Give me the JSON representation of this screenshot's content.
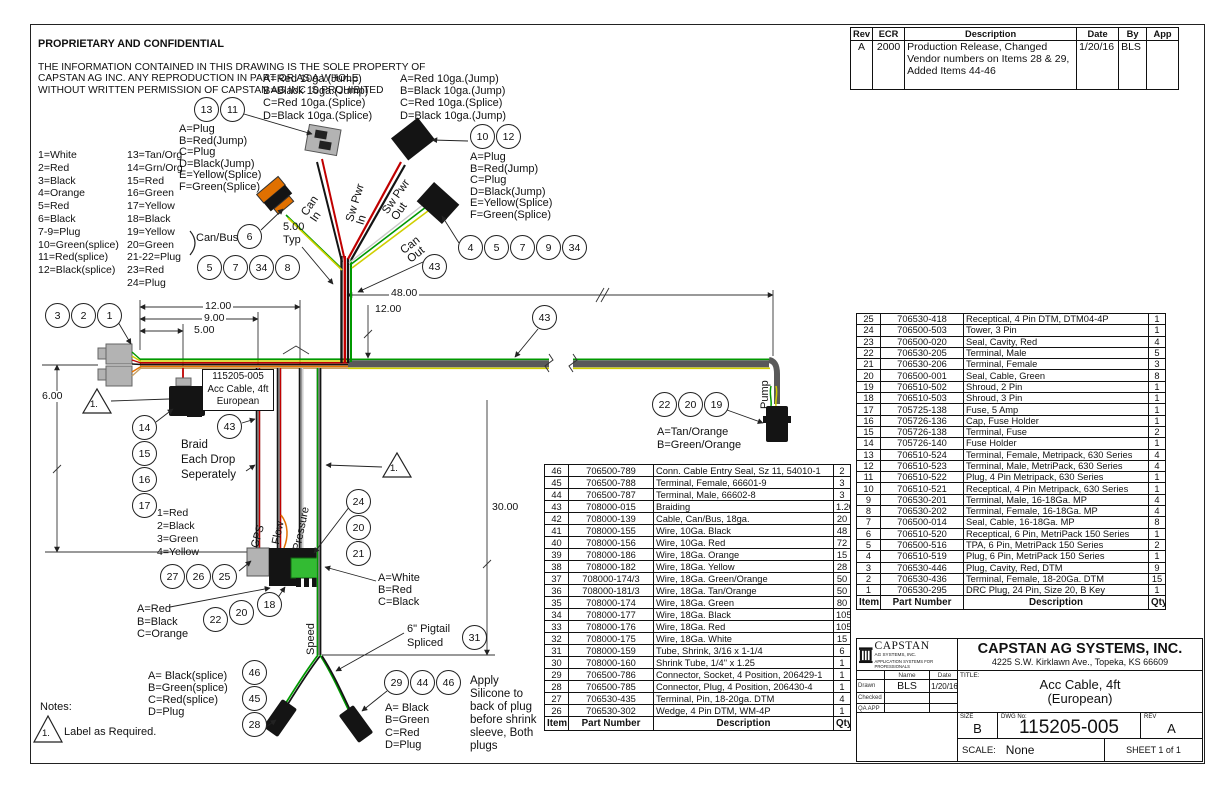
{
  "proprietary": {
    "title": "PROPRIETARY AND CONFIDENTIAL",
    "body": [
      "THE INFORMATION CONTAINED IN THIS DRAWING IS THE SOLE PROPERTY OF",
      "CAPSTAN AG INC. ANY REPRODUCTION IN PART OR AS A WHOLE",
      "WITHOUT WRITTEN PERMISSION OF CAPSTAN AG INC IS PROHIBITED"
    ]
  },
  "rev_table": {
    "headers": [
      "Rev",
      "ECR",
      "Description",
      "Date",
      "By",
      "App"
    ],
    "rows": [
      [
        "A",
        "2000",
        "Production Release, Changed Vendor numbers on Items 28 & 29, Added Items 44-46",
        "1/20/16",
        "BLS",
        ""
      ]
    ]
  },
  "legend": {
    "col1": [
      "1=White",
      "2=Red",
      "3=Black",
      "4=Orange",
      "5=Red",
      "6=Black",
      "7-9=Plug",
      "10=Green(splice)",
      "11=Red(splice)",
      "12=Black(splice)"
    ],
    "col2": [
      "13=Tan/Org",
      "14=Grn/Org",
      "15=Red",
      "16=Green",
      "17=Yellow",
      "18=Black",
      "19=Yellow",
      "20=Green",
      "21-22=Plug",
      "23=Red",
      "24=Plug"
    ],
    "canbus": "Can/Bus"
  },
  "callouts": {
    "jump_left": [
      "A=Red 10ga.(Jump)",
      "B=Black 10ga.(Jump)",
      "C=Red 10ga.(Splice)",
      "D=Black 10ga.(Splice)"
    ],
    "jump_right": [
      "A=Red 10ga.(Jump)",
      "B=Black 10ga.(Jump)",
      "C=Red 10ga.(Splice)",
      "D=Black 10ga.(Jump)"
    ],
    "plug_left": [
      "A=Plug",
      "B=Red(Jump)",
      "C=Plug",
      "D=Black(Jump)",
      "E=Yellow(Splice)",
      "F=Green(Splice)"
    ],
    "plug_right": [
      "A=Plug",
      "B=Red(Jump)",
      "C=Plug",
      "D=Black(Jump)",
      "E=Yellow(Splice)",
      "F=Green(Splice)"
    ],
    "five_typ": [
      "5.00",
      "Typ"
    ],
    "part_box": [
      "115205-005",
      "Acc Cable, 4ft",
      "European"
    ],
    "braid_note": [
      "Braid",
      "Each Drop",
      "Seperately"
    ],
    "pump_pins": [
      "A=Tan/Orange",
      "B=Green/Orange"
    ],
    "gps_pins": [
      "1=Red",
      "2=Black",
      "3=Green",
      "4=Yellow"
    ],
    "flow_pins": [
      "A=Red",
      "B=Black",
      "C=Orange"
    ],
    "pressure_pins": [
      "A=White",
      "B=Red",
      "C=Black"
    ],
    "speed_left_pins": [
      "A= Black(splice)",
      "B=Green(splice)",
      "C=Red(splice)",
      "D=Plug"
    ],
    "speed_right_pins": [
      "A= Black",
      "B=Green",
      "C=Red",
      "D=Plug"
    ],
    "pigtail_note": [
      "6\" Pigtail",
      "Spliced"
    ],
    "silicone_note": [
      "Apply",
      "Silicone to",
      "back of plug",
      "before shrink",
      "sleeve, Both",
      "plugs"
    ]
  },
  "wire_labels": {
    "sw_pwr_in": [
      "Sw Pwr",
      "In"
    ],
    "sw_pwr_out": [
      "Sw Pwr",
      "Out"
    ],
    "can_in": [
      "Can",
      "In"
    ],
    "can_out": [
      "Can",
      "Out"
    ],
    "pump": "Pump",
    "gps": "GPS",
    "flow": "Flow",
    "pressure": "Pressure",
    "speed": "Speed"
  },
  "dims": {
    "d48": "48.00",
    "d12_top": "12.00",
    "d12": "12.00",
    "d9": "9.00",
    "d5": "5.00",
    "d6": "6.00",
    "d30": "30.00"
  },
  "flags": {
    "f1": "1.",
    "f2": "1."
  },
  "notes": {
    "title": "Notes:",
    "flag": "1.",
    "note1": "Label as Required."
  },
  "balloons": {
    "g13_11": [
      13,
      11
    ],
    "g10_12": [
      10,
      12
    ],
    "g6": [
      6
    ],
    "row5_7_34_8": [
      5,
      7,
      34,
      8
    ],
    "row4_5_7_9_34": [
      4,
      5,
      7,
      9,
      34
    ],
    "g43a": [
      43
    ],
    "g43b": [
      43
    ],
    "g43c": [
      43
    ],
    "g3_2_1": [
      3,
      2,
      1
    ],
    "col14_17": [
      14,
      15,
      16,
      17
    ],
    "g22_20_19": [
      22,
      20,
      19
    ],
    "col24_20_21": [
      24,
      20,
      21
    ],
    "g27_26_25": [
      27,
      26,
      25
    ],
    "g22b": [
      22
    ],
    "g20b": [
      20
    ],
    "g18": [
      18
    ],
    "col46_45_28": [
      46,
      45,
      28
    ],
    "g29_44_46": [
      29,
      44,
      46
    ],
    "g31": [
      31
    ]
  },
  "bom_left": {
    "headers": [
      "Item",
      "Part Number",
      "Description",
      "Qty"
    ],
    "rows": [
      [
        "46",
        "706500-789",
        "Conn. Cable Entry Seal, Sz 11, 54010-1",
        "2"
      ],
      [
        "45",
        "706500-788",
        "Terminal, Female, 66601-9",
        "3"
      ],
      [
        "44",
        "706500-787",
        "Terminal, Male, 66602-8",
        "3"
      ],
      [
        "43",
        "708000-015",
        "Braiding",
        "1.20"
      ],
      [
        "42",
        "708000-139",
        "Cable, Can/Bus, 18ga.",
        "20"
      ],
      [
        "41",
        "708000-155",
        "Wire, 10Ga. Black",
        "48"
      ],
      [
        "40",
        "708000-156",
        "Wire, 10Ga. Red",
        "72"
      ],
      [
        "39",
        "708000-186",
        "Wire, 18Ga. Orange",
        "15"
      ],
      [
        "38",
        "708000-182",
        "Wire, 18Ga. Yellow",
        "28"
      ],
      [
        "37",
        "708000-174/3",
        "Wire, 18Ga. Green/Orange",
        "50"
      ],
      [
        "36",
        "708000-181/3",
        "Wire, 18Ga. Tan/Orange",
        "50"
      ],
      [
        "35",
        "708000-174",
        "Wire, 18Ga. Green",
        "80"
      ],
      [
        "34",
        "708000-177",
        "Wire, 18Ga. Black",
        "105"
      ],
      [
        "33",
        "708000-176",
        "Wire, 18Ga. Red",
        "105"
      ],
      [
        "32",
        "708000-175",
        "Wire, 18Ga. White",
        "15"
      ],
      [
        "31",
        "708000-159",
        "Tube, Shrink, 3/16 x 1-1/4",
        "6"
      ],
      [
        "30",
        "708000-160",
        "Shrink Tube, 1/4\" x 1.25",
        "1"
      ],
      [
        "29",
        "706500-786",
        "Connector, Socket, 4 Position, 206429-1",
        "1"
      ],
      [
        "28",
        "706500-785",
        "Connector, Plug, 4 Position, 206430-4",
        "1"
      ],
      [
        "27",
        "706530-435",
        "Terminal, Pin, 18-20ga. DTM",
        "4"
      ],
      [
        "26",
        "706530-302",
        "Wedge, 4 Pin DTM, WM-4P",
        "1"
      ]
    ]
  },
  "bom_right": {
    "headers": [
      "Item",
      "Part Number",
      "Description",
      "Qty"
    ],
    "rows": [
      [
        "25",
        "706530-418",
        "Receptical, 4 Pin DTM, DTM04-4P",
        "1"
      ],
      [
        "24",
        "706500-503",
        "Tower, 3 Pin",
        "1"
      ],
      [
        "23",
        "706500-020",
        "Seal, Cavity, Red",
        "4"
      ],
      [
        "22",
        "706530-205",
        "Terminal, Male",
        "5"
      ],
      [
        "21",
        "706530-206",
        "Terminal, Female",
        "3"
      ],
      [
        "20",
        "706500-001",
        "Seal, Cable, Green",
        "8"
      ],
      [
        "19",
        "706510-502",
        "Shroud, 2 Pin",
        "1"
      ],
      [
        "18",
        "706510-503",
        "Shroud, 3 Pin",
        "1"
      ],
      [
        "17",
        "705725-138",
        "Fuse, 5 Amp",
        "1"
      ],
      [
        "16",
        "705726-136",
        "Cap, Fuse Holder",
        "1"
      ],
      [
        "15",
        "705726-138",
        "Terminal, Fuse",
        "2"
      ],
      [
        "14",
        "705726-140",
        "Fuse Holder",
        "1"
      ],
      [
        "13",
        "706510-524",
        "Terminal, Female, Metripack, 630 Series",
        "4"
      ],
      [
        "12",
        "706510-523",
        "Terminal, Male, MetriPack, 630 Series",
        "4"
      ],
      [
        "11",
        "706510-522",
        "Plug, 4 Pin Metripack, 630 Series",
        "1"
      ],
      [
        "10",
        "706510-521",
        "Receptical, 4 Pin Metripack, 630 Series",
        "1"
      ],
      [
        "9",
        "706530-201",
        "Terminal, Male, 16-18Ga. MP",
        "4"
      ],
      [
        "8",
        "706530-202",
        "Terminal, Female, 16-18Ga. MP",
        "4"
      ],
      [
        "7",
        "706500-014",
        "Seal, Cable, 16-18Ga. MP",
        "8"
      ],
      [
        "6",
        "706510-520",
        "Receptical, 6 Pin, MetriPack 150 Series",
        "1"
      ],
      [
        "5",
        "706500-516",
        "TPA, 6 Pin, MetriPack 150 Series",
        "2"
      ],
      [
        "4",
        "706510-519",
        "Plug, 6 Pin, MetriPack 150 Series",
        "1"
      ],
      [
        "3",
        "706530-446",
        "Plug, Cavity, Red, DTM",
        "9"
      ],
      [
        "2",
        "706530-436",
        "Terminal, Female, 18-20Ga. DTM",
        "15"
      ],
      [
        "1",
        "706530-295",
        "DRC Plug, 24 Pin, Size 20, B Key",
        "1"
      ]
    ]
  },
  "title_block": {
    "logo_name": "CAPSTAN",
    "logo_sub": "AG SYSTEMS, INC.",
    "logo_tagline": "APPLICATION SYSTEMS FOR PROFESSIONALS",
    "company": "CAPSTAN AG SYSTEMS, INC.",
    "address": "4225 S.W. Kirklawn Ave., Topeka, KS 66609",
    "name_label": "Name",
    "date_label": "Date",
    "drawn_label": "Drawn",
    "checked_label": "Checked",
    "qa_label": "QA APP",
    "drawn_name": "BLS",
    "drawn_date": "1/20/16",
    "title_label": "TITLE:",
    "title": [
      "Acc Cable, 4ft",
      "(European)"
    ],
    "size_label": "SIZE",
    "size": "B",
    "dwg_label": "DWG No:",
    "dwg_no": "115205-005",
    "rev_label": "REV",
    "rev": "A",
    "scale_label": "SCALE:",
    "scale": "None",
    "sheet": "SHEET 1 of 1"
  },
  "colors": {
    "wire_green": "#009900",
    "wire_yellow": "#cfcf00",
    "wire_red": "#c00000",
    "wire_black": "#141414",
    "wire_orange": "#e07000",
    "wire_tan": "#c8a064",
    "wire_white": "#c8c8c8",
    "braid": "#595959",
    "drop_braid": "#8a8a8a",
    "connector_gray": "#b3b3b3",
    "connector_green": "#33bb33"
  }
}
